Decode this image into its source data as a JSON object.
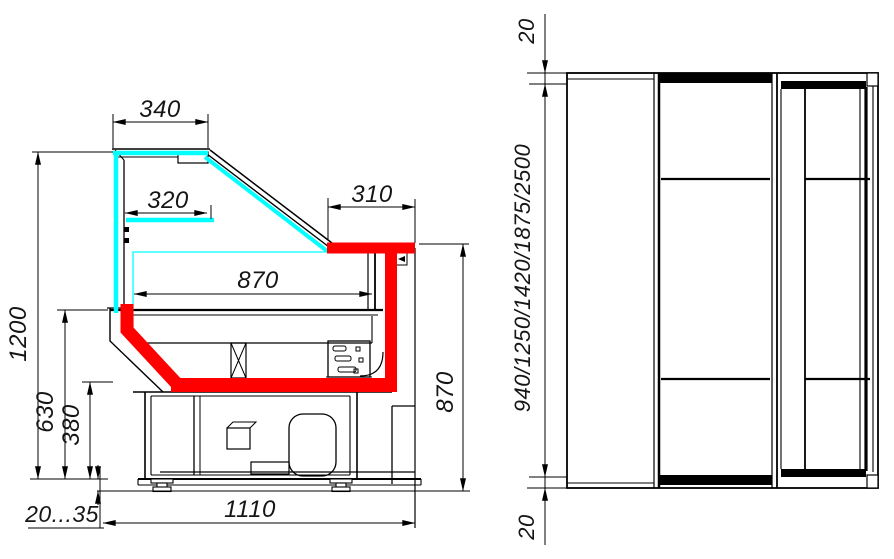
{
  "drawing": {
    "left_view": {
      "dimensions": {
        "canopy_width": "340",
        "shelf_width": "320",
        "counter_top_width": "310",
        "well_depth": "870",
        "overall_height": "1200",
        "front_panel_height": "630",
        "lower_panel_height": "380",
        "foot_height_range": "20...35",
        "base_depth": "1110",
        "counter_height": "870"
      }
    },
    "right_view": {
      "dimensions": {
        "top_overhang": "20",
        "length_options": "940/1250/1420/1875/2500",
        "bottom_overhang": "20"
      }
    },
    "colors": {
      "glass": "#00ffff",
      "accent": "#ff0000",
      "line": "#000000",
      "background": "#ffffff"
    }
  }
}
